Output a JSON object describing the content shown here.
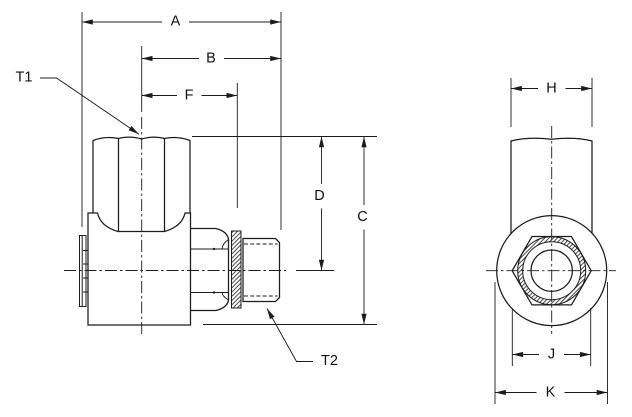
{
  "page": {
    "background_color": "#ffffff",
    "line_color": "#1c1c1c"
  },
  "side_view": {
    "dimension_labels": {
      "A": "A",
      "B": "B",
      "F": "F",
      "D": "D",
      "C": "C"
    },
    "port_labels": {
      "T1": "T1",
      "T2": "T2"
    }
  },
  "end_view": {
    "dimension_labels": {
      "H": "H",
      "J": "J",
      "K": "K"
    }
  }
}
